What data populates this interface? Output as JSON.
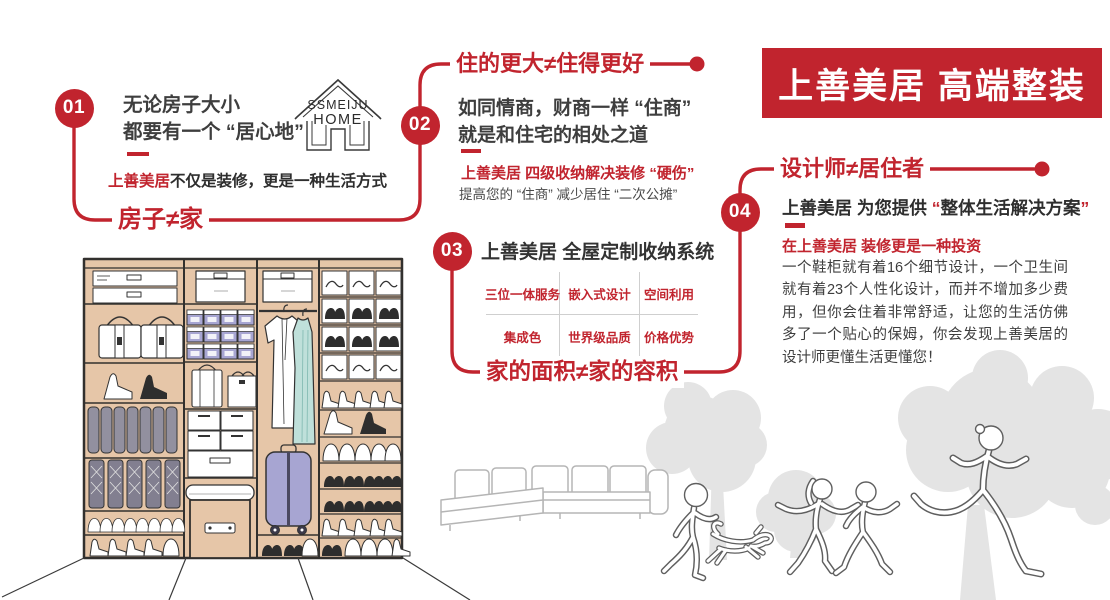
{
  "banner": {
    "title": "上善美居 高端整装"
  },
  "logo": {
    "line1": "SSMEIJU",
    "line2": "HOME"
  },
  "colors": {
    "accent": "#C1242E",
    "text": "#3E3E3E",
    "wood": "#E6C6A8",
    "lilac": "#A7A5D2",
    "teal": "#BFE0DA",
    "tree_gray": "#E4E4E4"
  },
  "s01": {
    "badge": "01",
    "line1": "无论房子大小",
    "line2": "都要有一个 “居心地”",
    "brand": "上善美居",
    "slogan": "不仅是装修，更是一种生活方式",
    "tagline": "房子≠家"
  },
  "s02": {
    "badge": "02",
    "title": "住的更大≠住得更好",
    "line1": "如同情商，财商一样 “住商”",
    "line2": "就是和住宅的相处之道",
    "highlight": "上善美居 四级收纳解决装修 “硬伤”",
    "note": "提高您的 “住商” 减少居住 “二次公摊”"
  },
  "s03": {
    "badge": "03",
    "title": "上善美居 全屋定制收纳系统",
    "table": {
      "rows": [
        [
          "三位一体服务",
          "嵌入式设计",
          "空间利用"
        ],
        [
          "集成色",
          "世界级品质",
          "价格优势"
        ]
      ]
    },
    "tagline": "家的面积≠家的容积"
  },
  "s04": {
    "badge": "04",
    "title": "设计师≠居住者",
    "head_prefix": "上善美居 为您提供 ",
    "quote_open": "“",
    "head_main": "整体生活解决方案",
    "quote_close": "”",
    "highlight": "在上善美居 装修更是一种投资",
    "body": "一个鞋柜就有着16个细节设计，一个卫生间就有着23个人性化设计，而并不增加多少费用，但你会住着非常舒适，让您的生活仿佛多了一个贴心的保姆，你会发现上善美居的设计师更懂生活更懂您！"
  }
}
